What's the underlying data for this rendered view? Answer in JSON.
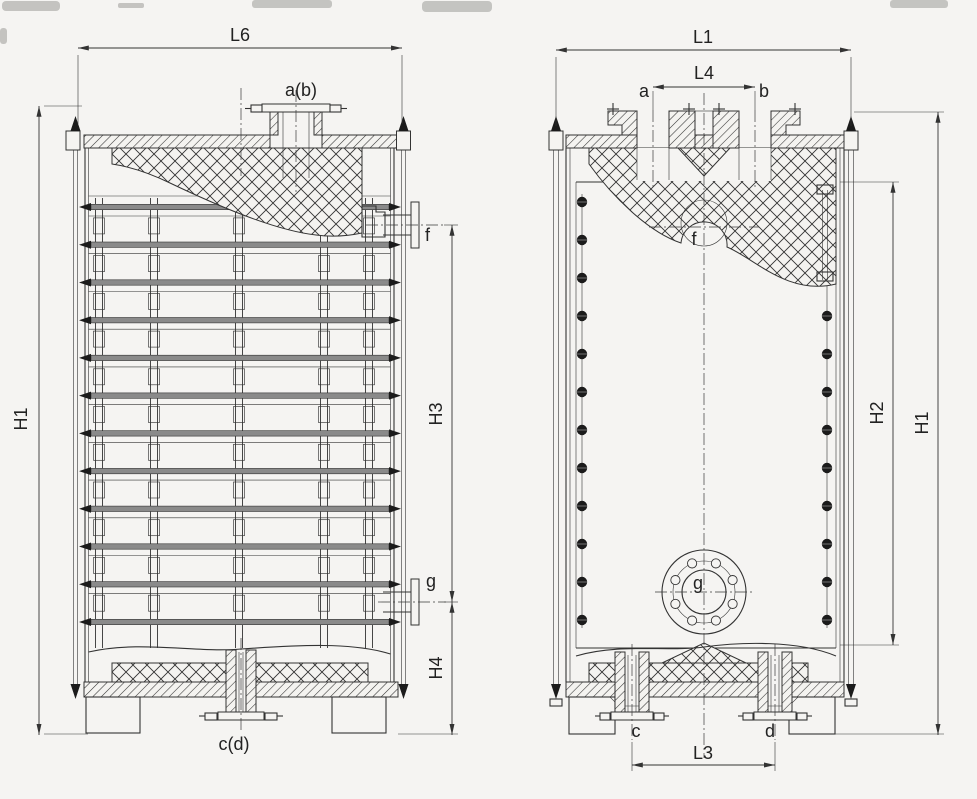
{
  "page": {
    "background": "#f5f4f2",
    "description": "Scanned dimensional engineering drawing of a vertical block heat exchanger shown in two sectional views"
  },
  "drawing": {
    "colors": {
      "line": "#333333",
      "tube_bar_fill": "#8a8a8a",
      "bolt_fill": "#1b1b1b",
      "paper": "#f5f4f2"
    },
    "front_view": {
      "dims": {
        "width_top": "L6",
        "height_overall": "H1",
        "height_upper": "H3",
        "height_lower": "H4"
      },
      "ports": {
        "top": "a(b)",
        "upper_right": "f",
        "lower_right": "g",
        "bottom": "c(d)"
      }
    },
    "side_view": {
      "dims": {
        "width_top": "L1",
        "top_nozzle_span": "L4",
        "bottom_nozzle_span": "L3",
        "height_inner": "H2",
        "height_overall": "H1"
      },
      "ports": {
        "top_left": "a",
        "top_right": "b",
        "upper_center": "f",
        "lower_center": "g",
        "bottom_left": "c",
        "bottom_right": "d"
      }
    }
  }
}
